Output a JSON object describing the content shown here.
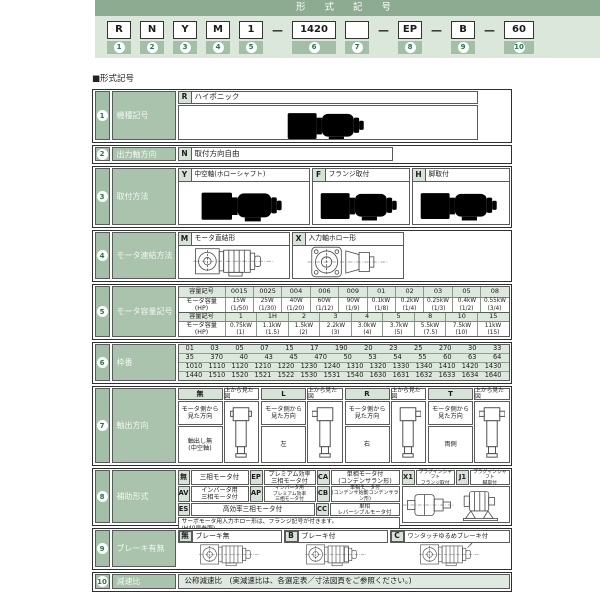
{
  "colors": {
    "bar_green": "#8cab91",
    "band_green": "#dbe7db",
    "badge_green": "#a3bfa7",
    "number_green": "#1f7a4b",
    "label_green": "#a9c3ac",
    "chip_green": "#d6e3d6",
    "subhead_green": "#dbe8db"
  },
  "titlebar": {
    "title": "形 式 記 号"
  },
  "code_line": {
    "dash": "—",
    "units": [
      {
        "code": "R",
        "num": "1"
      },
      {
        "code": "N",
        "num": "2"
      },
      {
        "code": "Y",
        "num": "3"
      },
      {
        "code": "M",
        "num": "4"
      },
      {
        "code": "1",
        "num": "5"
      },
      {
        "code": "1420",
        "num": "6"
      },
      {
        "code": "",
        "num": "7"
      },
      {
        "code": "EP",
        "num": "8"
      },
      {
        "code": "B",
        "num": "9"
      },
      {
        "code": "60",
        "num": "10"
      }
    ]
  },
  "section_title": "■形式記号",
  "rows": {
    "r1": {
      "num": "1",
      "label": "機種記号",
      "code": "R",
      "desc": "ハイポニック"
    },
    "r2": {
      "num": "2",
      "label": "出力軸方向",
      "code": "N",
      "desc": "取付方向自由"
    },
    "r3": {
      "num": "3",
      "label": "取付方法",
      "options": [
        {
          "code": "Y",
          "text": "中空軸(ホローシャフト)"
        },
        {
          "code": "F",
          "text": "フランジ取付"
        },
        {
          "code": "H",
          "text": "脚取付"
        }
      ]
    },
    "r4": {
      "num": "4",
      "label": "モータ連結方法",
      "options": [
        {
          "code": "M",
          "text": "モータ直結形"
        },
        {
          "code": "X",
          "text": "入力軸ホロー形"
        }
      ]
    },
    "r5": {
      "num": "5",
      "label": "モータ容量記号",
      "cap_header": "容量記号",
      "power_header": "モータ容量\n(HP)",
      "table1": {
        "codes": [
          "0015",
          "0025",
          "004",
          "006",
          "009",
          "01",
          "02",
          "03",
          "05",
          "08"
        ],
        "powers": [
          {
            "main": "15W",
            "sub": "(1/50)"
          },
          {
            "main": "25W",
            "sub": "(1/30)"
          },
          {
            "main": "40W",
            "sub": "(1/20)"
          },
          {
            "main": "60W",
            "sub": "(1/12)"
          },
          {
            "main": "90W",
            "sub": "(1/9)"
          },
          {
            "main": "0.1kW",
            "sub": "(1/8)"
          },
          {
            "main": "0.2kW",
            "sub": "(1/4)"
          },
          {
            "main": "0.25kW",
            "sub": "(1/3)"
          },
          {
            "main": "0.4kW",
            "sub": "(1/2)"
          },
          {
            "main": "0.55kW",
            "sub": "(3/4)"
          }
        ]
      },
      "table2": {
        "codes": [
          "1",
          "1H",
          "2",
          "3",
          "4",
          "5",
          "8",
          "10",
          "15"
        ],
        "powers": [
          {
            "main": "0.75kW",
            "sub": "(1)"
          },
          {
            "main": "1.1kW",
            "sub": "(1.5)"
          },
          {
            "main": "1.5kW",
            "sub": "(2)"
          },
          {
            "main": "2.2kW",
            "sub": "(3)"
          },
          {
            "main": "3.0kW",
            "sub": "(4)"
          },
          {
            "main": "3.7kW",
            "sub": "(5)"
          },
          {
            "main": "5.5kW",
            "sub": "(7.5)"
          },
          {
            "main": "7.5kW",
            "sub": "(10)"
          },
          {
            "main": "11kW",
            "sub": "(15)"
          }
        ]
      }
    },
    "r6": {
      "num": "6",
      "label": "枠番",
      "lines": [
        [
          "01",
          "03",
          "05",
          "07",
          "15",
          "17",
          "190",
          "20",
          "23",
          "25",
          "270",
          "30",
          "33"
        ],
        [
          "35",
          "370",
          "40",
          "43",
          "45",
          "470",
          "50",
          "53",
          "54",
          "55",
          "60",
          "63",
          "64"
        ],
        [
          "1010",
          "1110",
          "1120",
          "1210",
          "1220",
          "1230",
          "1240",
          "1310",
          "1320",
          "1330",
          "1340",
          "1410",
          "1420",
          "1430"
        ],
        [
          "1440",
          "1510",
          "1520",
          "1521",
          "1522",
          "1530",
          "1531",
          "1540",
          "1630",
          "1631",
          "1632",
          "1633",
          "1634",
          "1640"
        ]
      ]
    },
    "r7": {
      "num": "7",
      "label": "軸出方向",
      "view_header": "上から見た図",
      "dir_label": "モータ側から\n見た方向",
      "options": [
        {
          "code": "無",
          "out": "軸出し無\n(中空軸)"
        },
        {
          "code": "L",
          "out": "左"
        },
        {
          "code": "R",
          "out": "右"
        },
        {
          "code": "T",
          "out": "両側"
        }
      ]
    },
    "r8": {
      "num": "8",
      "label": "補助形式",
      "row1": [
        {
          "code": "無",
          "text": "三相モータ付"
        },
        {
          "code": "EP",
          "text": "プレミアム効率\n三相モータ付"
        },
        {
          "code": "CA",
          "text": "単相モータ付\n(コンデンサラン形)"
        },
        {
          "code": "X1",
          "text": "プラグインシャフト\nフランジ取付"
        },
        {
          "code": "J1",
          "text": "プラグインシャフト\n脚取付"
        }
      ],
      "row2": [
        {
          "code": "AV",
          "text": "インバータ用\n三相モータ付"
        },
        {
          "code": "AP",
          "text": "インバータ用\nプレミアム効率\n三相モータ付"
        },
        {
          "code": "CB",
          "text": "単相モータ付\n(コンデンサ始動コンデンサラン形)"
        }
      ],
      "row3": [
        {
          "code": "ES",
          "text": "高効率三相モータ付"
        },
        {
          "code": "CC",
          "text": "単相\nレバーシブルモータ付"
        }
      ],
      "note": "サーボモータ用入力ホロー形は、フランジ記号が付きます。\n(H40頁参照)"
    },
    "r9": {
      "num": "9",
      "label": "ブレーキ有無",
      "options": [
        {
          "code": "無",
          "text": "ブレーキ無"
        },
        {
          "code": "B",
          "text": "ブレーキ付"
        },
        {
          "code": "C",
          "text": "ワンタッチゆるめブレーキ付"
        }
      ]
    },
    "r10": {
      "num": "10",
      "label": "減速比",
      "text": "公称減速比　(実減速比は、各選定表／寸法図頁をご参照ください。)"
    }
  }
}
